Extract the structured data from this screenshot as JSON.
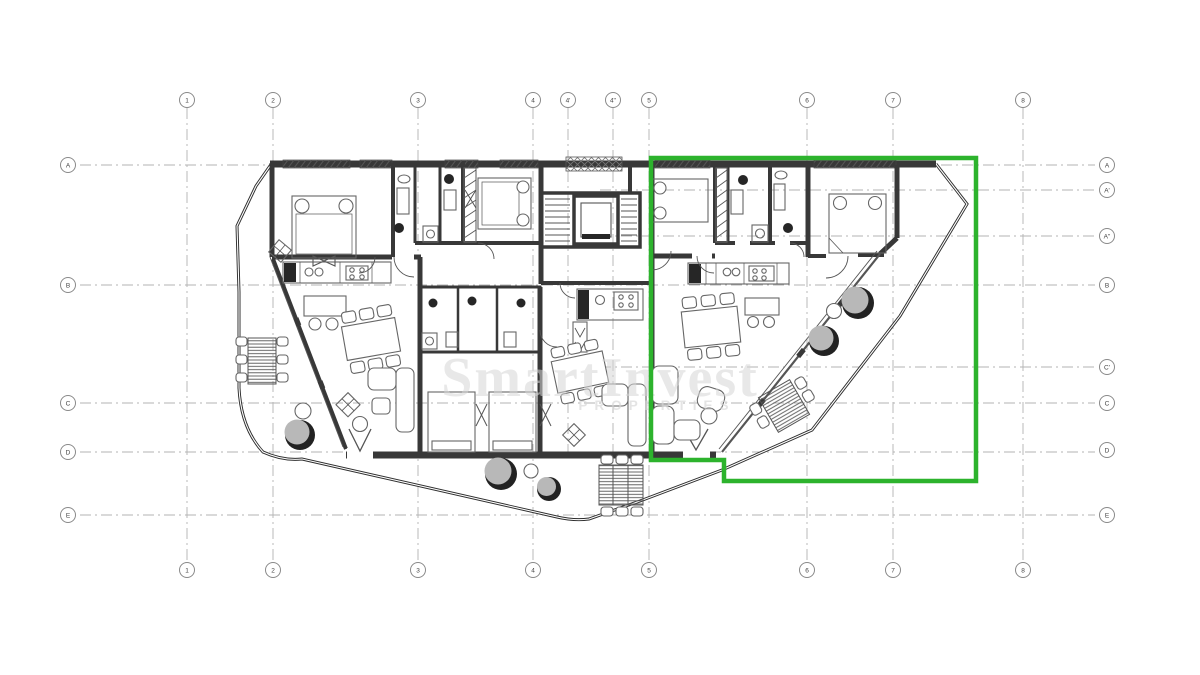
{
  "canvas": {
    "width": 1200,
    "height": 675,
    "background": "#ffffff"
  },
  "highlight": {
    "color": "#2db32d",
    "label": "selected-apartment-outline"
  },
  "watermark": {
    "line1": "SmartInvest",
    "line2": "PROPERTIES",
    "color": "#d6d6d6"
  },
  "plan": {
    "wall_color": "#383838",
    "parapet_color": "#2e2e2e",
    "grid_line_color": "#b3b3b3"
  },
  "grid": {
    "top": {
      "bubble_y": 100,
      "line_from": 108,
      "line_to": 561,
      "partial_line_to": 455,
      "items": [
        {
          "label": "1",
          "x": 187
        },
        {
          "label": "2",
          "x": 273
        },
        {
          "label": "3",
          "x": 418
        },
        {
          "label": "4",
          "x": 533
        },
        {
          "label": "4'",
          "x": 568,
          "partial": true
        },
        {
          "label": "4''",
          "x": 613,
          "partial": true
        },
        {
          "label": "5",
          "x": 649
        },
        {
          "label": "6",
          "x": 807
        },
        {
          "label": "7",
          "x": 893
        },
        {
          "label": "8",
          "x": 1023
        }
      ]
    },
    "bottom": {
      "bubble_y": 570,
      "items": [
        {
          "label": "1",
          "x": 187
        },
        {
          "label": "2",
          "x": 273
        },
        {
          "label": "3",
          "x": 418
        },
        {
          "label": "4",
          "x": 533
        },
        {
          "label": "5",
          "x": 649
        },
        {
          "label": "6",
          "x": 807
        },
        {
          "label": "7",
          "x": 893
        },
        {
          "label": "8",
          "x": 1023
        }
      ]
    },
    "left": {
      "bubble_x": 68,
      "line_from": 80,
      "line_to": 1095,
      "items": [
        {
          "label": "A",
          "y": 165
        },
        {
          "label": "B",
          "y": 285
        },
        {
          "label": "C",
          "y": 403
        },
        {
          "label": "D",
          "y": 452
        },
        {
          "label": "E",
          "y": 515
        }
      ]
    },
    "right": {
      "bubble_x": 1107,
      "partial_line_from": 600,
      "items": [
        {
          "label": "A",
          "y": 165
        },
        {
          "label": "A'",
          "y": 190,
          "partial": true
        },
        {
          "label": "A''",
          "y": 236,
          "partial": true
        },
        {
          "label": "B",
          "y": 285
        },
        {
          "label": "C'",
          "y": 367,
          "partial": true
        },
        {
          "label": "C",
          "y": 403
        },
        {
          "label": "D",
          "y": 450
        },
        {
          "label": "E",
          "y": 515
        }
      ]
    }
  }
}
